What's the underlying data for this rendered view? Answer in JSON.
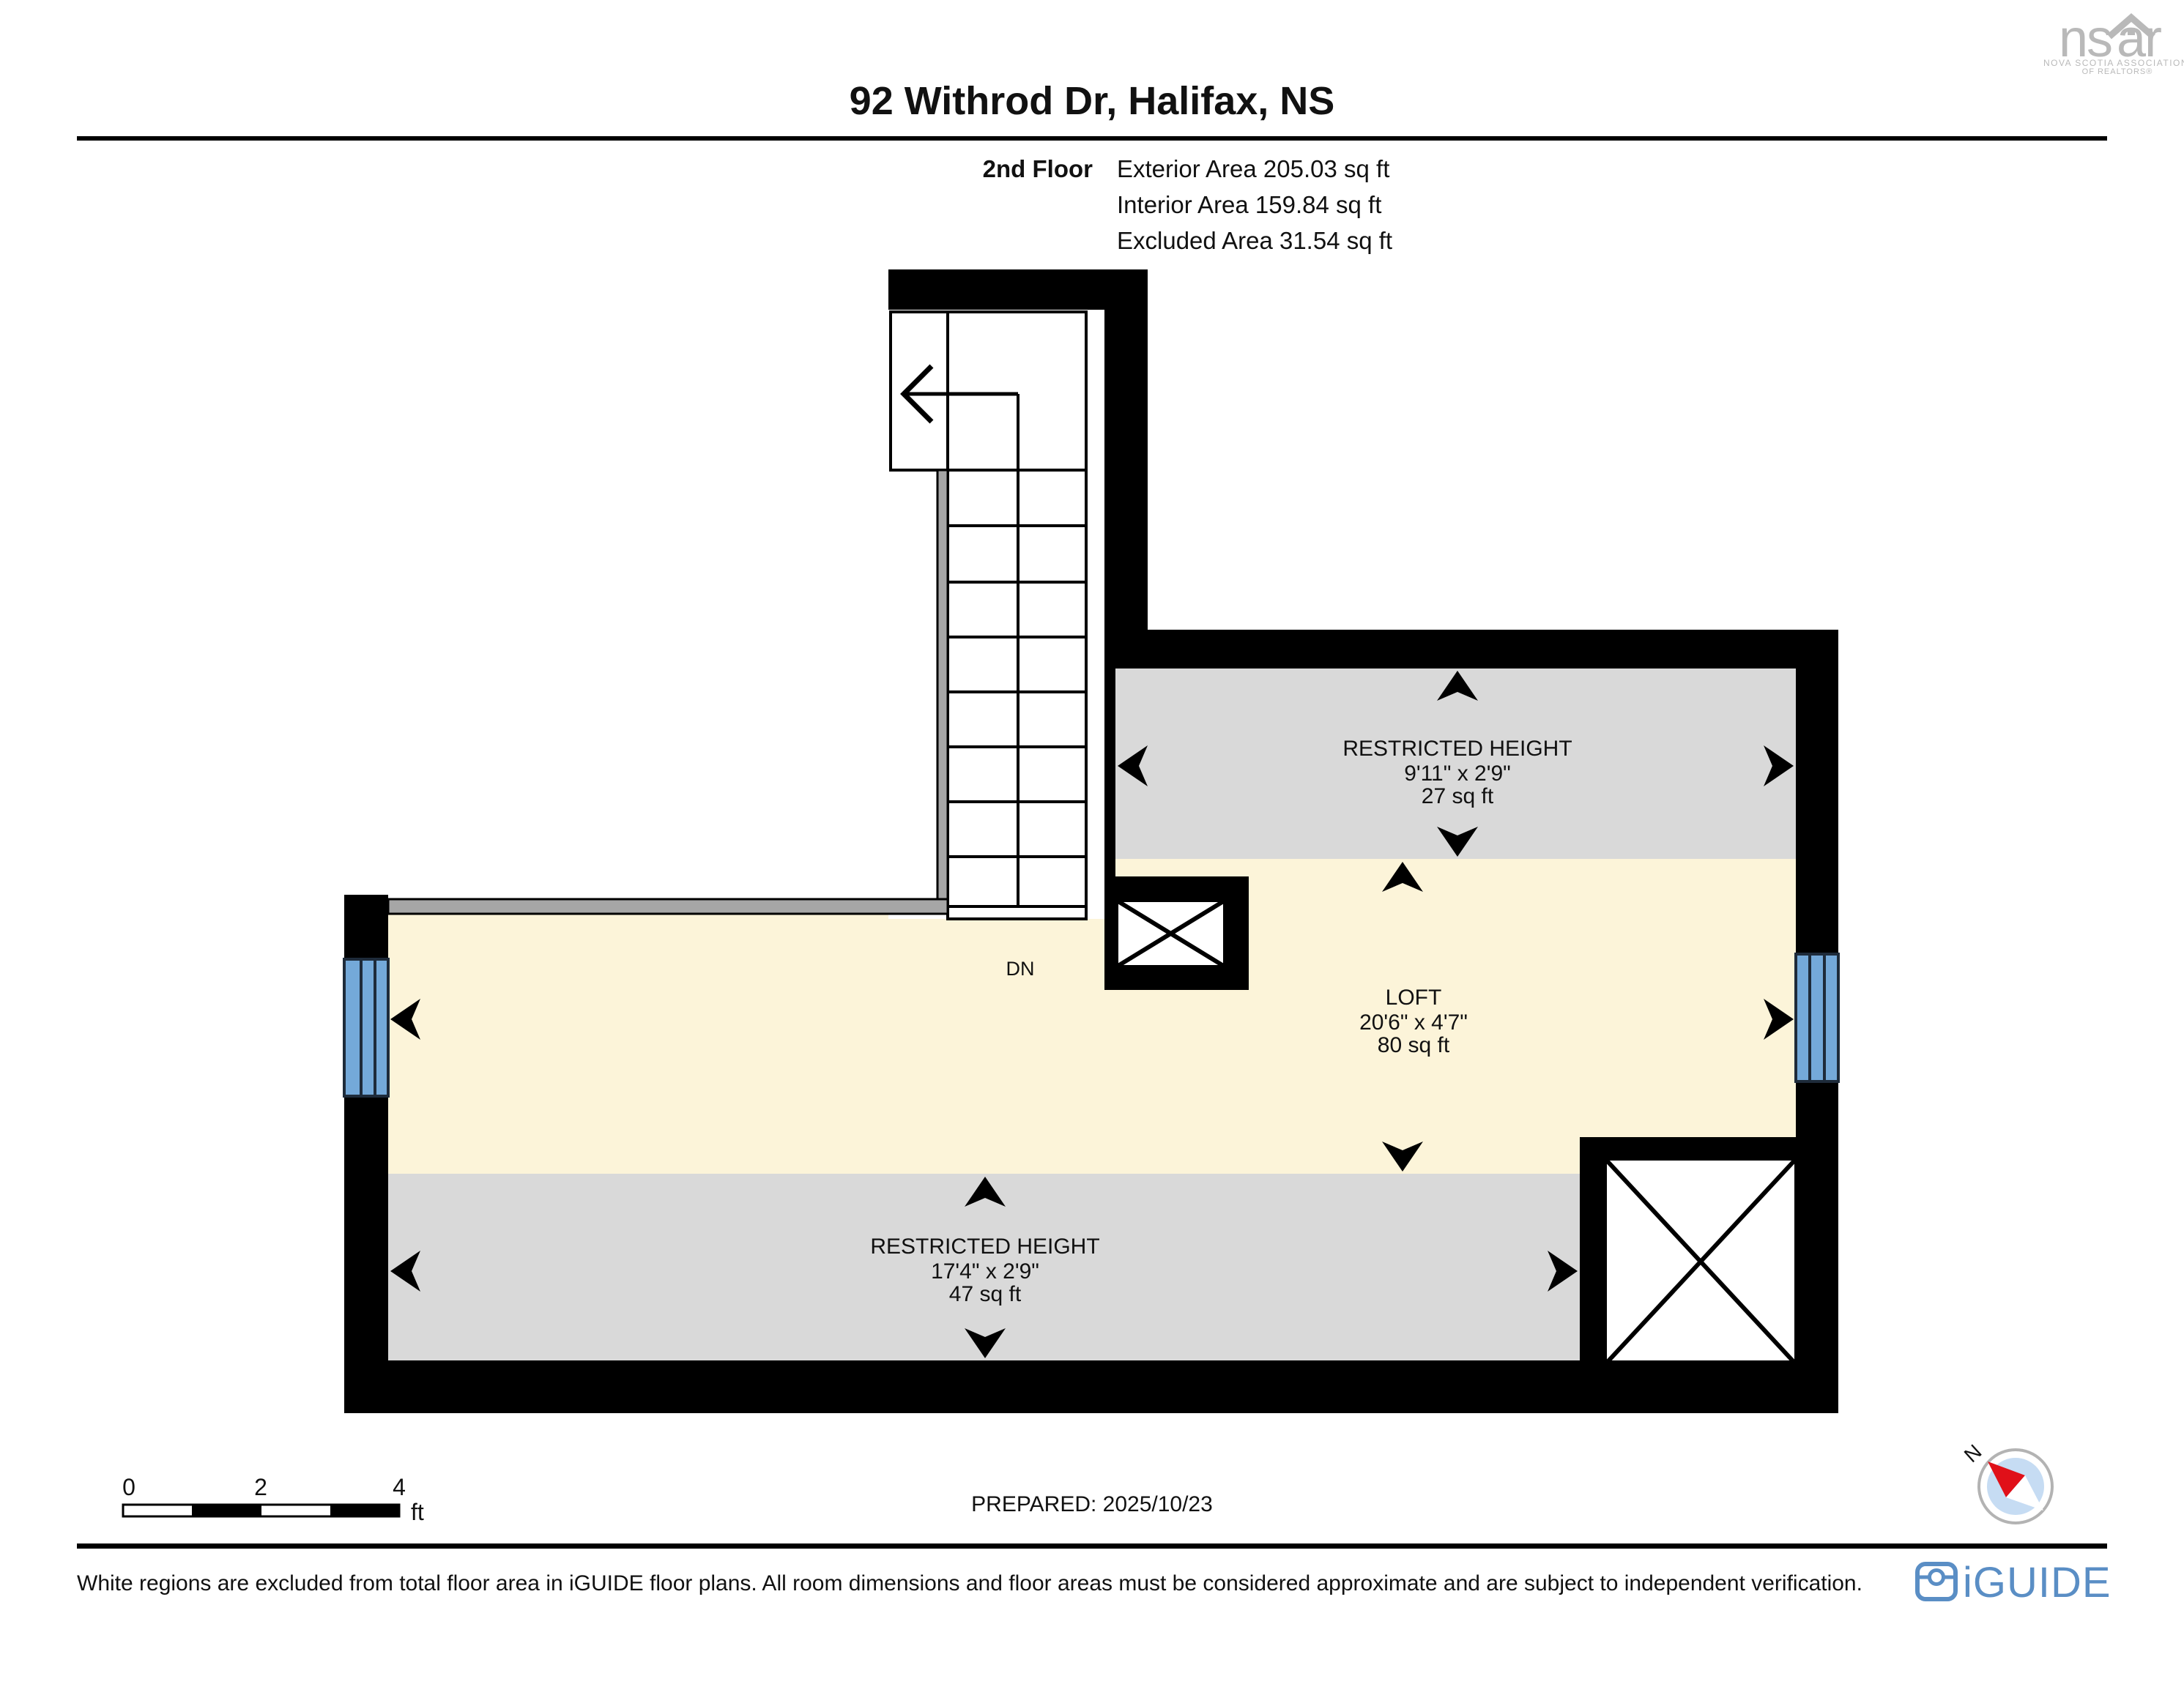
{
  "header": {
    "title": "92 Withrod Dr, Halifax, NS",
    "floor_label": "2nd Floor",
    "exterior": "Exterior Area 205.03 sq ft",
    "interior": "Interior Area 159.84 sq ft",
    "excluded": "Excluded Area 31.54 sq ft"
  },
  "nsar_logo": {
    "left": "ns",
    "right": "ar",
    "line1": "NOVA SCOTIA ASSOCIATION",
    "line2": "OF REALTORS®"
  },
  "plan": {
    "rooms": [
      {
        "id": "restricted-height-top",
        "name": "RESTRICTED HEIGHT",
        "dims": "9'11\" x 2'9\"",
        "area": "27 sq ft"
      },
      {
        "id": "loft",
        "name": "LOFT",
        "dims": "20'6\" x 4'7\"",
        "area": "80 sq ft"
      },
      {
        "id": "restricted-height-bottom",
        "name": "RESTRICTED HEIGHT",
        "dims": "17'4\" x 2'9\"",
        "area": "47 sq ft"
      }
    ],
    "stair_label": "DN",
    "colors": {
      "wall": "#000000",
      "loft_fill": "#fcf4d9",
      "restricted_fill": "#d9d9d9",
      "railing_fill": "#a6a6a6",
      "window_fill": "#74a9d9",
      "window_frame": "#1e2b3a"
    }
  },
  "footer": {
    "scale": {
      "tick0": "0",
      "tick1": "2",
      "tick2": "4",
      "unit": "ft"
    },
    "prepared": "PREPARED: 2025/10/23",
    "compass_label": "N",
    "disclaimer": "White regions are excluded from total floor area in iGUIDE floor plans. All room dimensions and floor areas must be considered approximate and are subject to independent verification.",
    "iguide": "iGUIDE"
  }
}
